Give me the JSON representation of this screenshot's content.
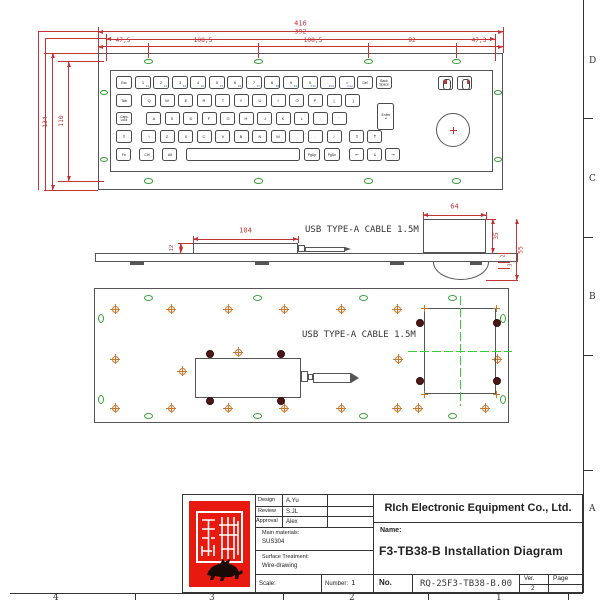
{
  "colors": {
    "dim_red": "#c43434",
    "line_gray": "#555555",
    "key_gray": "#4a4a4a",
    "hole_green": "#3a9e3a",
    "centerline_green": "#35cc35",
    "screw_orange": "#c8772c",
    "screw_dark": "#4d1717",
    "fkey_blue": "#3a57c4",
    "stamp_red": "#e8190f"
  },
  "frame": {
    "zone_letters": [
      "D",
      "C",
      "B",
      "A"
    ],
    "zone_numbers": [
      "4",
      "3",
      "2",
      "1"
    ]
  },
  "top_view": {
    "dims": {
      "overall_width": "416",
      "hole_span_width": "392",
      "seg1": "47,5",
      "seg2": "108,5",
      "seg3": "108,5",
      "seg4": "92",
      "seg5": "47,3",
      "overall_height": "134",
      "hole_span_height": "110"
    },
    "keyboard": {
      "row1": [
        "Esc",
        "1",
        "2",
        "3",
        "4",
        "5",
        "6",
        "7",
        "8",
        "9",
        "0",
        "-",
        "=",
        "Del",
        "Back\nSpace"
      ],
      "f_row1": [
        "",
        "F1",
        "F2",
        "F3",
        "F4",
        "F5",
        "F6",
        "F7",
        "F8",
        "F9",
        "F10",
        "F11",
        "F12",
        "",
        ""
      ],
      "row2": [
        "Tab",
        "Q",
        "W",
        "E",
        "R",
        "T",
        "Y",
        "U",
        "I",
        "O",
        "P",
        "[",
        "]"
      ],
      "row3": [
        "Caps\nLock",
        "A",
        "S",
        "D",
        "F",
        "G",
        "H",
        "J",
        "K",
        "L",
        ";",
        "'"
      ],
      "enter": "Enter\n↵",
      "row4": [
        "⇧",
        "\\",
        "Z",
        "X",
        "C",
        "V",
        "B",
        "N",
        "M",
        ",",
        ".",
        "/",
        "⇧",
        "↑"
      ],
      "row5": [
        "Fn",
        "Ctrl",
        "Alt",
        "",
        "PgUp",
        "PgDn",
        "←",
        "↓",
        "→"
      ]
    },
    "mouse_buttons": [
      "mouse-left-click-button",
      "mouse-right-click-button"
    ],
    "trackball": "trackball"
  },
  "side_view": {
    "cable_label": "USB TYPE-A CABLE 1.5M",
    "dims": {
      "usb_box_length": "104",
      "usb_box_height": "12",
      "trackball_box_width": "64",
      "trackball_box_height": "35",
      "total_height": "55",
      "plate_thickness": "2",
      "stud_height": "3"
    }
  },
  "bottom_view": {
    "cable_label": "USB TYPE-A CABLE 1.5M"
  },
  "title_block": {
    "company": "RIch Electronic Equipment Co., Ltd.",
    "name_label": "Name:",
    "name": "F3-TB38-B Installation Diagram",
    "no_label": "No.",
    "no_value": "RQ-25F3-TB38-B.00",
    "ver_label": "Ver.",
    "ver_value": "2",
    "page_label": "Page",
    "design_label": "Design",
    "design_value": "A.Yu",
    "review_label": "Review",
    "review_value": "S.JL",
    "approval_label": "Approval",
    "approval_value": "Alex",
    "materials_label": "Main materials:",
    "materials_value": "SUS304",
    "surface_label": "Surface Treatment:",
    "surface_value": "Wire-drawing",
    "scale_label": "Scale:",
    "number_label": "Number:",
    "number_value": "1",
    "stamp_icon": "company-seal-stamp"
  }
}
